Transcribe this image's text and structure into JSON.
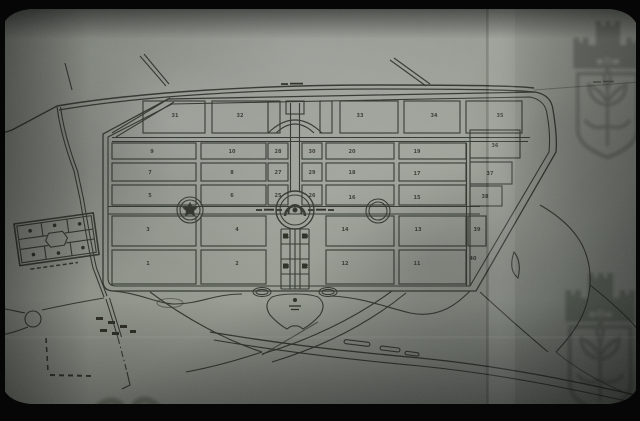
{
  "photo": {
    "subject": "aged photographed master plan with numbered burial plots",
    "watermarks": [
      "castle-crest-top-right",
      "castle-crest-bottom-right"
    ]
  },
  "colors": {
    "paper_light": "#9aa098",
    "paper_mid": "#7e847c",
    "paper_dark": "#4c514b",
    "film_black": "#050605",
    "ink": "#1f211a"
  },
  "plan": {
    "plots": [
      {
        "label": "31",
        "x": 175,
        "y": 117
      },
      {
        "label": "32",
        "x": 240,
        "y": 117
      },
      {
        "label": "33",
        "x": 360,
        "y": 117
      },
      {
        "label": "34",
        "x": 434,
        "y": 117
      },
      {
        "label": "35",
        "x": 500,
        "y": 117
      },
      {
        "label": "9",
        "x": 152,
        "y": 153
      },
      {
        "label": "10",
        "x": 232,
        "y": 153
      },
      {
        "label": "28",
        "x": 278,
        "y": 153
      },
      {
        "label": "30",
        "x": 312,
        "y": 153
      },
      {
        "label": "20",
        "x": 352,
        "y": 153
      },
      {
        "label": "19",
        "x": 417,
        "y": 153
      },
      {
        "label": "36",
        "x": 495,
        "y": 147
      },
      {
        "label": "7",
        "x": 150,
        "y": 174
      },
      {
        "label": "8",
        "x": 232,
        "y": 174
      },
      {
        "label": "27",
        "x": 278,
        "y": 174
      },
      {
        "label": "29",
        "x": 312,
        "y": 174
      },
      {
        "label": "18",
        "x": 352,
        "y": 174
      },
      {
        "label": "17",
        "x": 417,
        "y": 175
      },
      {
        "label": "37",
        "x": 490,
        "y": 175
      },
      {
        "label": "5",
        "x": 150,
        "y": 197
      },
      {
        "label": "6",
        "x": 232,
        "y": 197
      },
      {
        "label": "25",
        "x": 278,
        "y": 197
      },
      {
        "label": "26",
        "x": 312,
        "y": 197
      },
      {
        "label": "16",
        "x": 352,
        "y": 199
      },
      {
        "label": "15",
        "x": 417,
        "y": 199
      },
      {
        "label": "38",
        "x": 485,
        "y": 198
      },
      {
        "label": "3",
        "x": 148,
        "y": 231
      },
      {
        "label": "4",
        "x": 237,
        "y": 231
      },
      {
        "label": "21",
        "x": 286,
        "y": 238
      },
      {
        "label": "24",
        "x": 305,
        "y": 238
      },
      {
        "label": "14",
        "x": 345,
        "y": 231
      },
      {
        "label": "13",
        "x": 418,
        "y": 231
      },
      {
        "label": "39",
        "x": 477,
        "y": 231
      },
      {
        "label": "1",
        "x": 148,
        "y": 265
      },
      {
        "label": "2",
        "x": 237,
        "y": 265
      },
      {
        "label": "23",
        "x": 286,
        "y": 268
      },
      {
        "label": "22",
        "x": 305,
        "y": 268
      },
      {
        "label": "12",
        "x": 345,
        "y": 265
      },
      {
        "label": "11",
        "x": 417,
        "y": 265
      },
      {
        "label": "40",
        "x": 473,
        "y": 260
      }
    ]
  }
}
